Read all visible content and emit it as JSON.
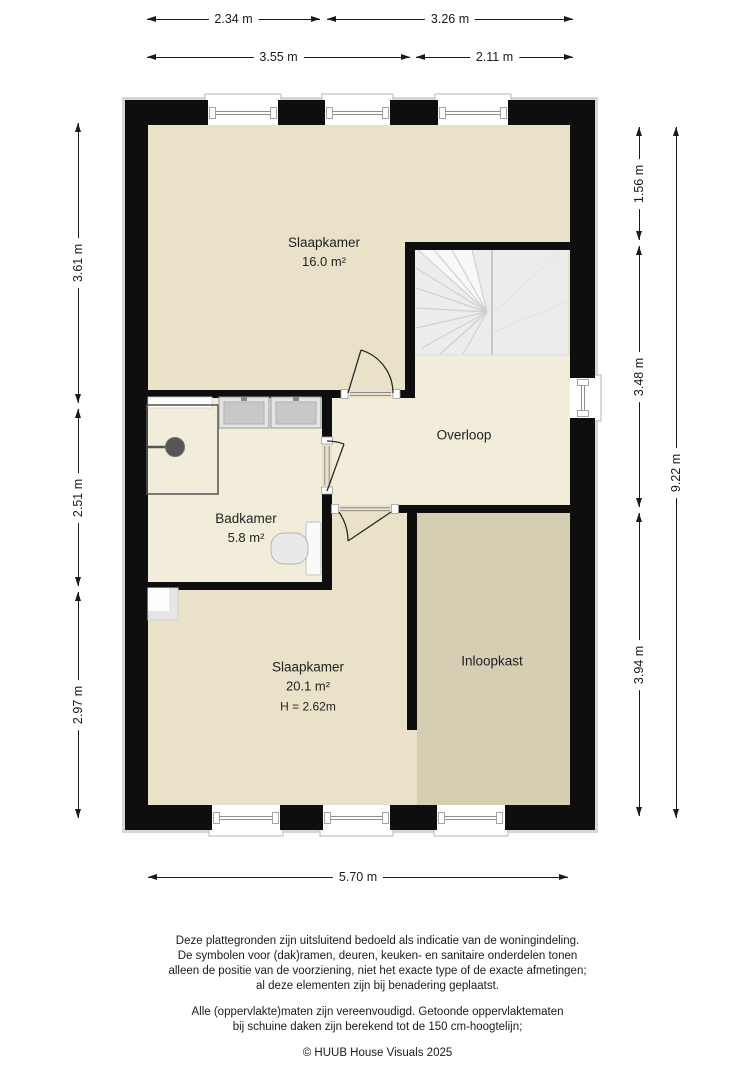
{
  "plan": {
    "rooms": [
      {
        "id": "slaapkamer-1",
        "name": "Slaapkamer",
        "area": "16.0 m²"
      },
      {
        "id": "overloop",
        "name": "Overloop"
      },
      {
        "id": "badkamer",
        "name": "Badkamer",
        "area": "5.8 m²"
      },
      {
        "id": "slaapkamer-2",
        "name": "Slaapkamer",
        "area": "20.1 m²",
        "ceiling_height": "H = 2.62m"
      },
      {
        "id": "inloopkast",
        "name": "Inloopkast"
      }
    ]
  },
  "dimensions": {
    "top_row_1": [
      "2.34 m",
      "3.26 m"
    ],
    "top_row_2": [
      "3.55 m",
      "2.11 m"
    ],
    "bottom": [
      "5.70 m"
    ],
    "left": [
      "3.61 m",
      "2.51 m",
      "2.97 m"
    ],
    "right_inner": [
      "1.56 m",
      "3.48 m",
      "3.94 m"
    ],
    "right_outer": [
      "9.22 m"
    ]
  },
  "footer": {
    "lines": [
      "Deze plattegronden zijn uitsluitend bedoeld als indicatie van de woningindeling.",
      "De symbolen voor (dak)ramen, deuren, keuken- en sanitaire onderdelen tonen",
      "alleen de positie van de voorziening, niet het exacte type of de exacte afmetingen;",
      "al deze elementen zijn bij benadering geplaatst.",
      "Alle (oppervlakte)maten zijn vereenvoudigd. Getoonde oppervlaktematen",
      "bij schuine daken zijn berekend tot de 150 cm-hoogtelijn;",
      "© HUUB House Visuals 2025"
    ]
  },
  "colors": {
    "wall": "#0e0e0e",
    "bedroom_floor": "#e9e2c9",
    "hall_bath_floor": "#f1edda",
    "closet_floor": "#d6ceb3",
    "stairs": "#ececec",
    "dimension_text": "#1a1a1a"
  },
  "icons": {
    "shower": "shower-icon",
    "washbasin": "sink-icon",
    "toilet": "toilet-icon",
    "stairs": "stairs-icon",
    "door": "door-swing-icon",
    "window": "window-icon"
  }
}
